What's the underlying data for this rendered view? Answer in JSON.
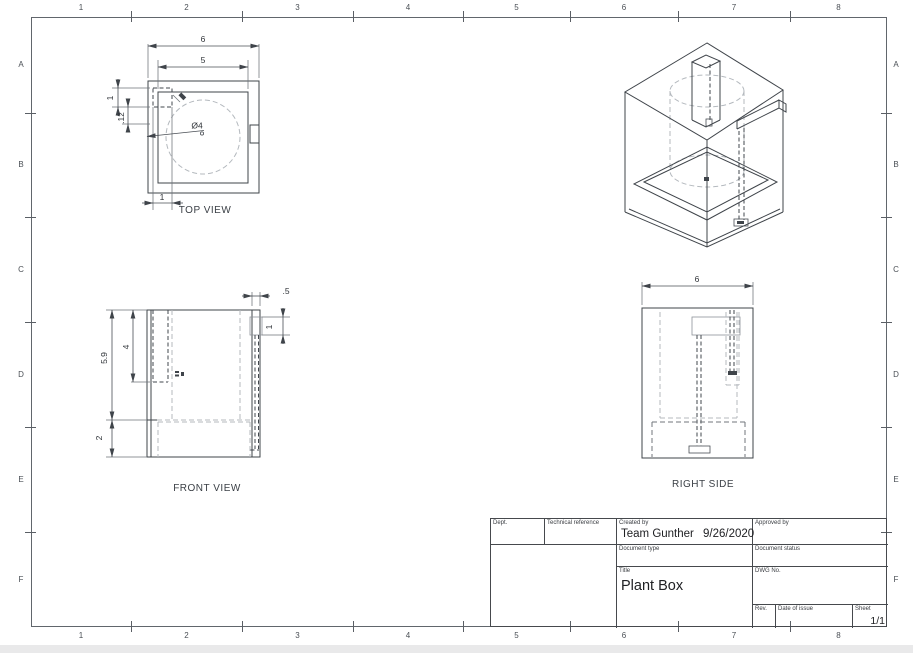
{
  "sheet": {
    "zone_columns": [
      "1",
      "2",
      "3",
      "4",
      "5",
      "6",
      "7",
      "8"
    ],
    "zone_rows": [
      "A",
      "B",
      "C",
      "D",
      "E",
      "F"
    ]
  },
  "views": {
    "top": {
      "label": "TOP VIEW",
      "dims": {
        "overall_width": "6",
        "inner_width": "5",
        "tab_height": "1",
        "wall_offset": ".12",
        "tab_width": "1",
        "hole_diameter": "Ø4"
      }
    },
    "front": {
      "label": "FRONT VIEW",
      "dims": {
        "wall_thickness": ".5",
        "notch_height": "1",
        "tube_depth": "4",
        "body_height": "5.9",
        "base_height": "2"
      }
    },
    "right": {
      "label": "RIGHT SIDE",
      "dims": {
        "overall_width": "6"
      }
    }
  },
  "title_block": {
    "dept_label": "Dept.",
    "technical_reference_label": "Technical reference",
    "created_by_label": "Created by",
    "created_by_value": "Team Gunther",
    "created_date": "9/26/2020",
    "approved_by_label": "Approved by",
    "document_type_label": "Document type",
    "document_status_label": "Document status",
    "title_label": "Title",
    "title_value": "Plant Box",
    "dwg_no_label": "DWG No.",
    "rev_label": "Rev.",
    "date_of_issue_label": "Date of issue",
    "sheet_label": "Sheet",
    "sheet_value": "1/1"
  },
  "colors": {
    "outline": "#3f444a",
    "hidden_gray": "#b4b9be",
    "frame": "#61666c",
    "paper": "#ffffff",
    "backdrop": "#e9e9ea"
  }
}
